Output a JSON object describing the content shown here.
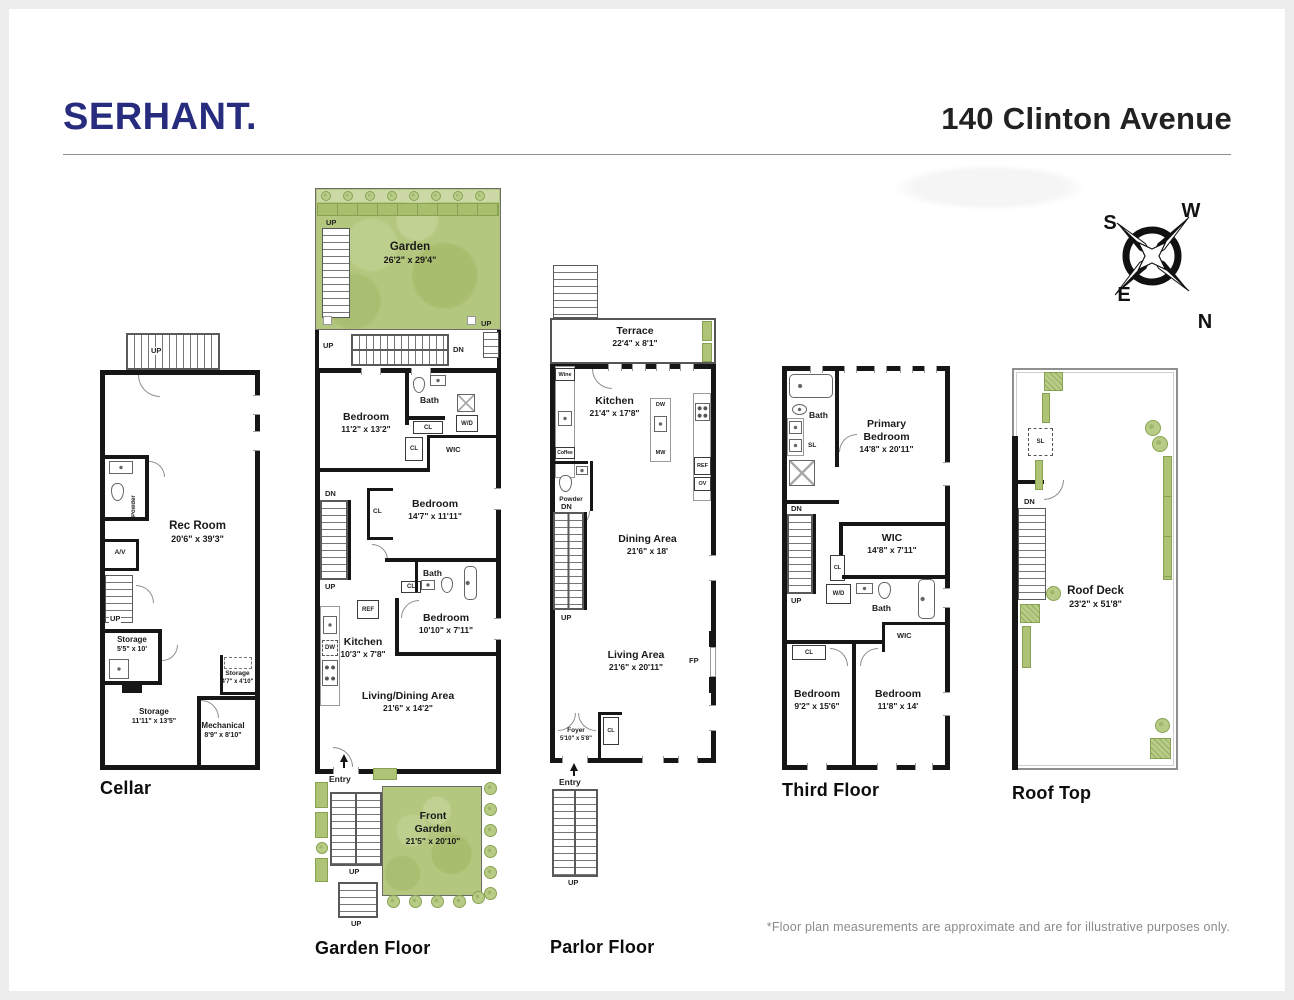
{
  "header": {
    "brand": "SERHANT.",
    "address": "140 Clinton Avenue"
  },
  "footnote": "*Floor plan measurements are approximate and are for illustrative purposes only.",
  "compass": {
    "s": "S",
    "w": "W",
    "e": "E",
    "n": "N"
  },
  "labels": {
    "up": "UP",
    "dn": "DN",
    "entry": "Entry",
    "cl": "CL",
    "wic": "WIC",
    "bath": "Bath",
    "powder": "Powder",
    "av": "A/V",
    "ref": "REF",
    "dw": "DW",
    "mw": "MW",
    "ov": "OV",
    "fp": "FP",
    "sl": "SL",
    "wd": "W/D",
    "wine": "Wine",
    "coffee": "Coffee"
  },
  "colors": {
    "brand_navy": "#272c7e",
    "garden_green": "#b4c77e",
    "wall_black": "#161616"
  },
  "floors": {
    "cellar": {
      "title": "Cellar",
      "rec": {
        "n": "Rec Room",
        "d": "20'6\" x 39'3\""
      },
      "st1": {
        "n": "Storage",
        "d": "5'5\" x 10'"
      },
      "st2": {
        "n": "Storage",
        "d": "4'7\" x 4'10\""
      },
      "st3": {
        "n": "Storage",
        "d": "11'11\" x 13'5\""
      },
      "mech": {
        "n": "Mechanical",
        "d": "8'9\" x 8'10\""
      }
    },
    "garden": {
      "title": "Garden Floor",
      "garden": {
        "n": "Garden",
        "d": "26'2\" x 29'4\""
      },
      "bed1": {
        "n": "Bedroom",
        "d": "11'2\" x 13'2\""
      },
      "bed2": {
        "n": "Bedroom",
        "d": "14'7\" x 11'11\""
      },
      "bed3": {
        "n": "Bedroom",
        "d": "10'10\" x 7'11\""
      },
      "kitchen": {
        "n": "Kitchen",
        "d": "10'3\" x 7'8\""
      },
      "living": {
        "n": "Living/Dining Area",
        "d": "21'6\" x 14'2\""
      },
      "fgarden": {
        "n": "Front Garden",
        "d": "21'5\" x 20'10\""
      }
    },
    "parlor": {
      "title": "Parlor Floor",
      "terrace": {
        "n": "Terrace",
        "d": "22'4\" x 8'1\""
      },
      "kitchen": {
        "n": "Kitchen",
        "d": "21'4\" x 17'8\""
      },
      "dining": {
        "n": "Dining Area",
        "d": "21'6\" x 18'"
      },
      "living": {
        "n": "Living Area",
        "d": "21'6\" x 20'11\""
      },
      "foyer": {
        "n": "Foyer",
        "d": "5'10\" x 5'8\""
      }
    },
    "third": {
      "title": "Third Floor",
      "primary": {
        "n": "Primary Bedroom",
        "d": "14'8\" x 20'11\""
      },
      "wic": {
        "n": "WIC",
        "d": "14'8\" x 7'11\""
      },
      "bed1": {
        "n": "Bedroom",
        "d": "9'2\" x 15'6\""
      },
      "bed2": {
        "n": "Bedroom",
        "d": "11'8\" x 14'"
      }
    },
    "roof": {
      "title": "Roof Top",
      "deck": {
        "n": "Roof Deck",
        "d": "23'2\" x 51'8\""
      }
    }
  }
}
